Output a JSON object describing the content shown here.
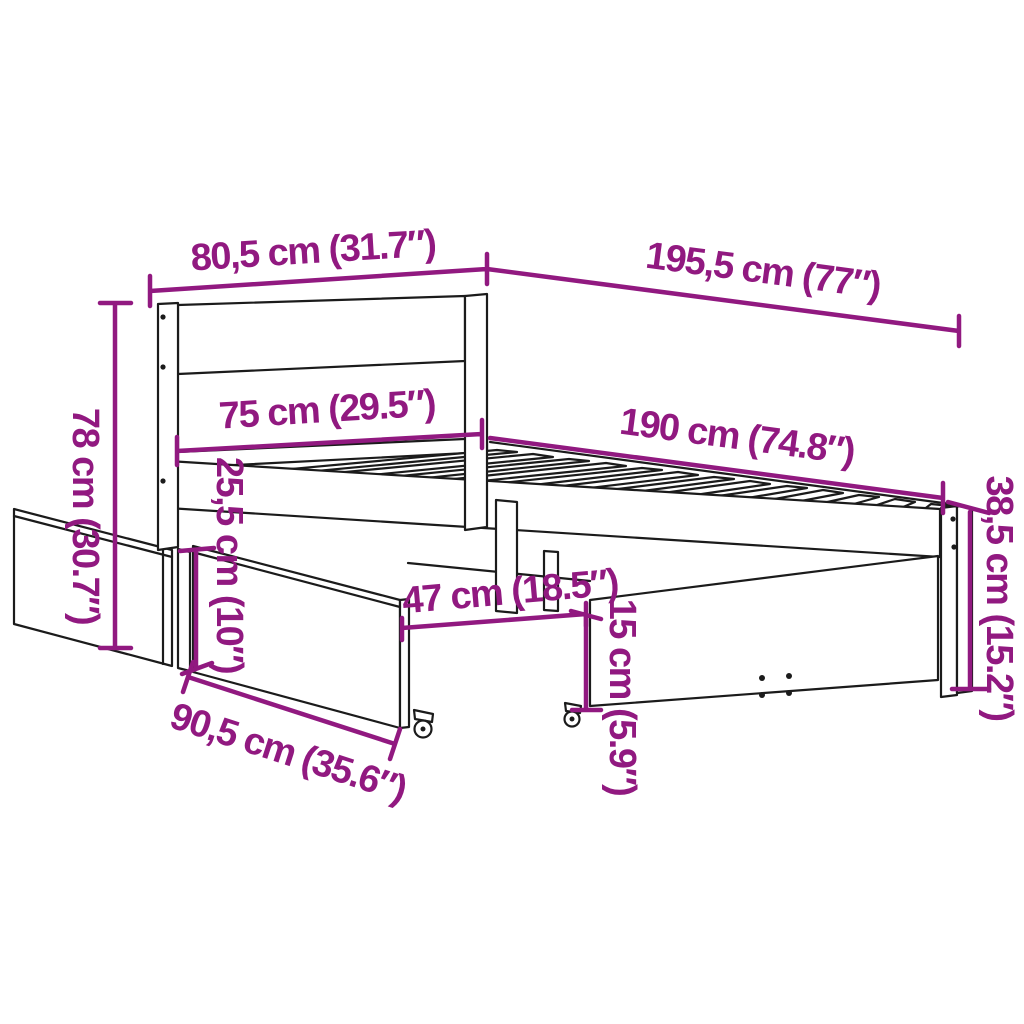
{
  "colors": {
    "dimension": "#911980",
    "line_art": "#1b1b1b",
    "background": "#ffffff"
  },
  "diagram": {
    "dimensions": {
      "headboard_width": "80,5 cm (31.7″)",
      "frame_length_total": "195,5 cm (77″)",
      "headboard_height": "78 cm (30.7″)",
      "inner_width": "75 cm (29.5″)",
      "inner_length": "190 cm (74.8″)",
      "frame_side_height": "38,5 cm (15.2″)",
      "rail_to_floor_clearance": "25,5 cm (10″)",
      "drawer_depth": "47 cm (18.5″)",
      "drawer_height": "15 cm (5.9″)",
      "drawer_width": "90,5 cm (35.6″)"
    }
  }
}
